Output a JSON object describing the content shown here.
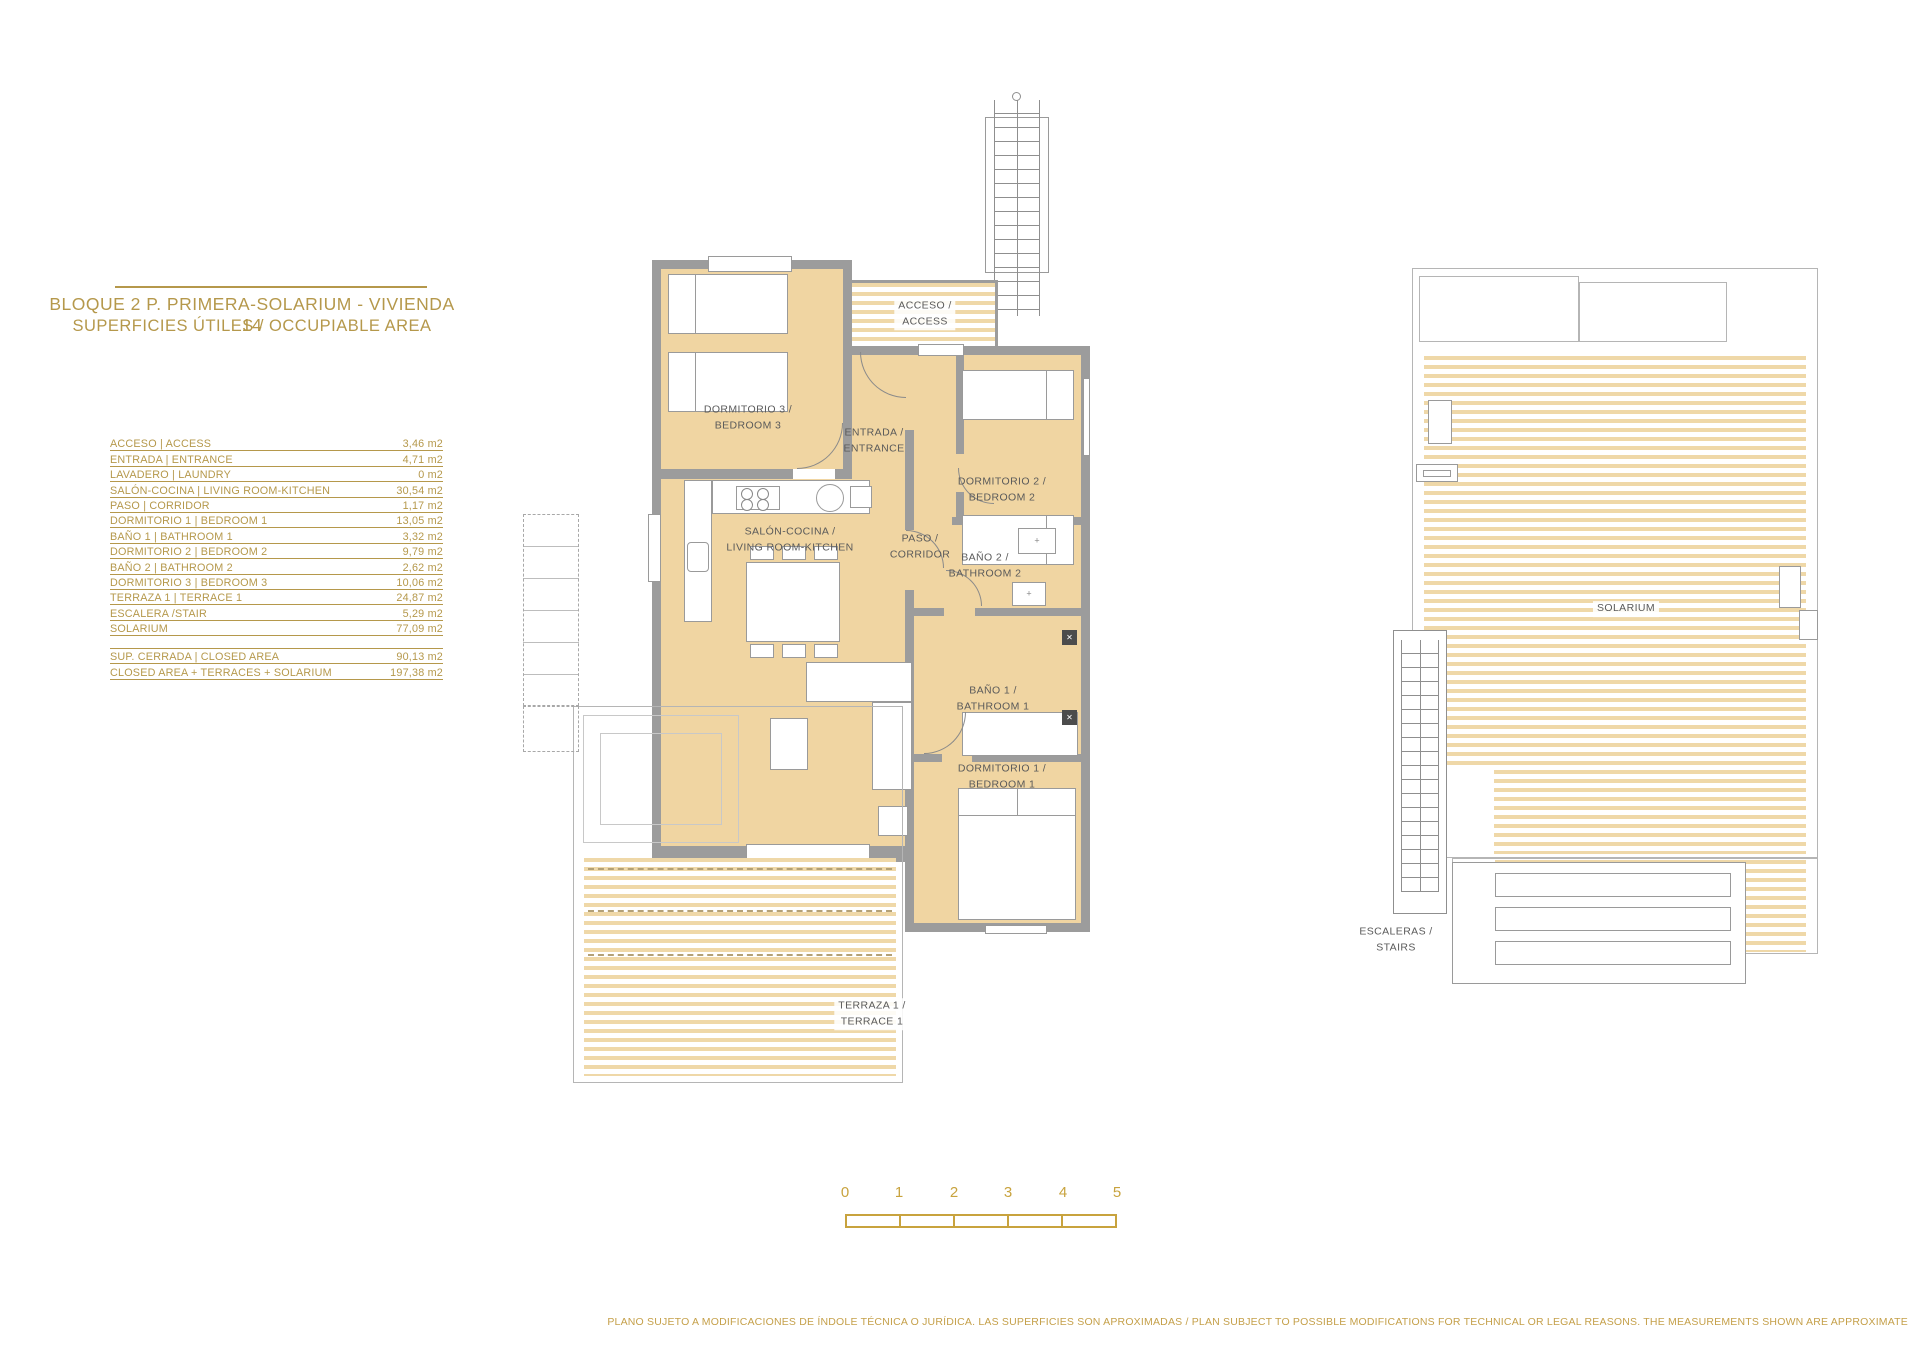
{
  "document": {
    "title_line1": "BLOQUE 2 P. PRIMERA-SOLARIUM - VIVIENDA 14",
    "title_line2": "SUPERFICIES ÚTILES / OCCUPIABLE AREA",
    "disclaimer": "PLANO SUJETO A MODIFICACIONES DE ÍNDOLE TÉCNICA O JURÍDICA. LAS SUPERFICIES SON APROXIMADAS / PLAN SUBJECT TO POSSIBLE MODIFICATIONS FOR TECHNICAL OR LEGAL REASONS. THE MEASUREMENTS SHOWN ARE APPROXIMATE"
  },
  "areas_table": {
    "rows": [
      {
        "label": "ACCESO | ACCESS",
        "value": "3,46 m2"
      },
      {
        "label": "ENTRADA | ENTRANCE",
        "value": "4,71 m2"
      },
      {
        "label": "LAVADERO | LAUNDRY",
        "value": "0 m2"
      },
      {
        "label": "SALÓN-COCINA | LIVING ROOM-KITCHEN",
        "value": "30,54 m2"
      },
      {
        "label": "PASO | CORRIDOR",
        "value": "1,17 m2"
      },
      {
        "label": "DORMITORIO 1 | BEDROOM 1",
        "value": "13,05 m2"
      },
      {
        "label": "BAÑO 1 | BATHROOM 1",
        "value": "3,32 m2"
      },
      {
        "label": "DORMITORIO 2 | BEDROOM 2",
        "value": "9,79 m2"
      },
      {
        "label": "BAÑO 2 | BATHROOM 2",
        "value": "2,62 m2"
      },
      {
        "label": "DORMITORIO 3 | BEDROOM 3",
        "value": "10,06 m2"
      },
      {
        "label": "TERRAZA 1 | TERRACE 1",
        "value": "24,87 m2"
      },
      {
        "label": "ESCALERA /STAIR",
        "value": "5,29 m2"
      },
      {
        "label": "SOLARIUM",
        "value": "77,09 m2"
      }
    ],
    "summary_rows": [
      {
        "label": "SUP. CERRADA | CLOSED AREA",
        "value": "90,13 m2"
      },
      {
        "label": "CLOSED AREA + TERRACES + SOLARIUM",
        "value": "197,38 m2"
      }
    ]
  },
  "floor_plan": {
    "rooms": [
      {
        "label": "ACCESO /\nACCESS"
      },
      {
        "label": "ENTRADA /\nENTRANCE"
      },
      {
        "label": "DORMITORIO 3 /\nBEDROOM 3"
      },
      {
        "label": "DORMITORIO 2 /\nBEDROOM 2"
      },
      {
        "label": "SALÓN-COCINA /\nLIVING ROOM-KITCHEN"
      },
      {
        "label": "PASO /\nCORRIDOR"
      },
      {
        "label": "BAÑO 2 /\nBATHROOM 2"
      },
      {
        "label": "BAÑO 1 /\nBATHROOM 1"
      },
      {
        "label": "DORMITORIO 1 /\nBEDROOM 1"
      },
      {
        "label": "TERRAZA 1 /\nTERRACE 1"
      }
    ]
  },
  "solarium_plan": {
    "rooms": [
      {
        "label": "SOLARIUM"
      },
      {
        "label": "ESCALERAS /\nSTAIRS"
      }
    ]
  },
  "scale_bar": {
    "ticks": [
      "0",
      "1",
      "2",
      "3",
      "4",
      "5"
    ]
  },
  "colors": {
    "brand_gold": "#B5984B",
    "scale_gold": "#C8A33E",
    "floor_tan": "#F0D5A2",
    "stripe_tan": "#EFD8A8",
    "wall_gray": "#9C9C9C",
    "label_gray": "#5A5A5A"
  }
}
